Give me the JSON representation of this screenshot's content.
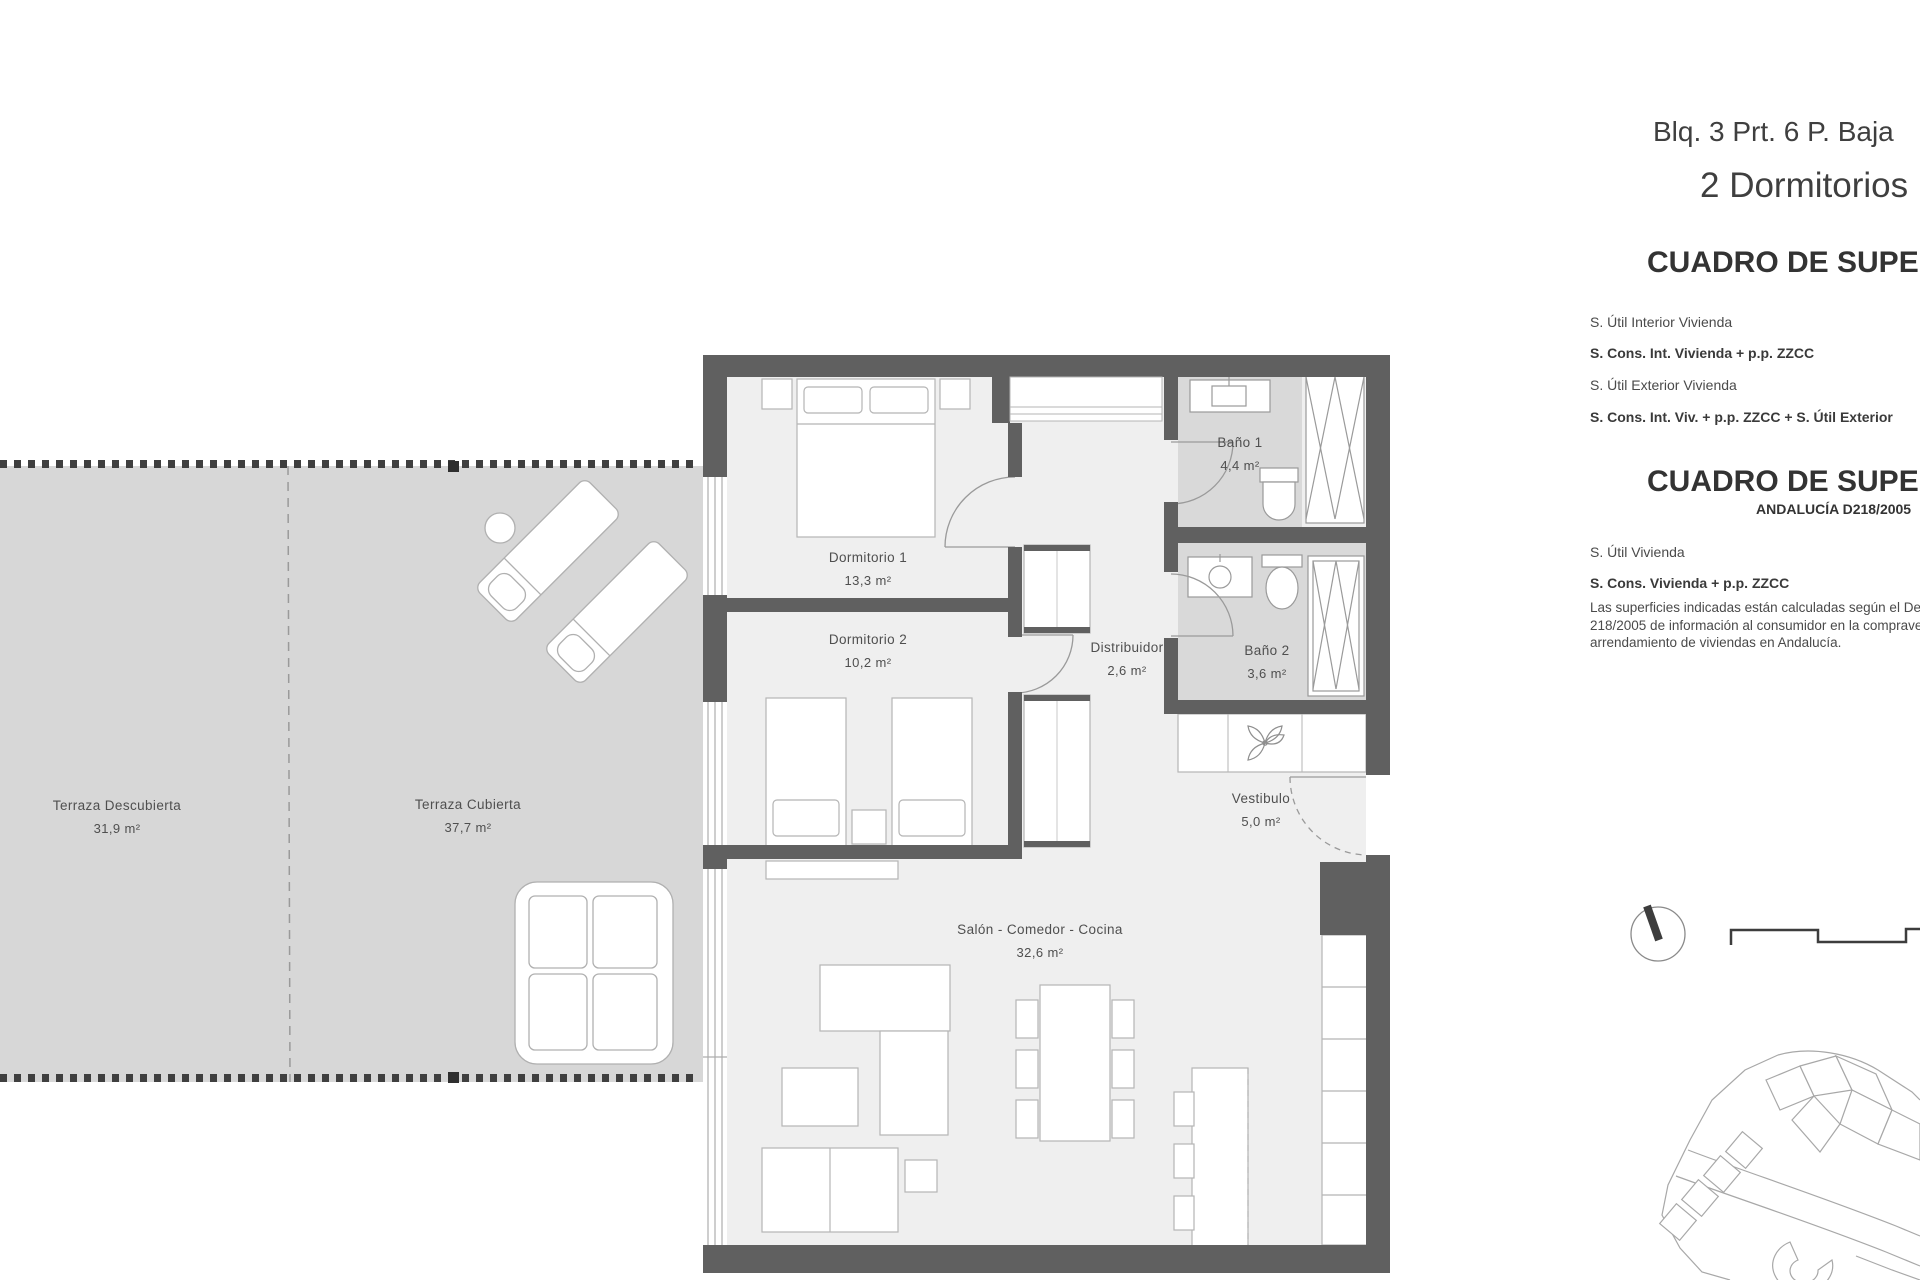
{
  "title": {
    "line1": "Blq. 3 Prt. 6 P. Baja",
    "line2": "2 Dormitorios"
  },
  "tables": {
    "t1": {
      "heading": "CUADRO DE SUPERFICIES",
      "rows": [
        "S. Útil Interior Vivienda",
        "S. Cons. Int. Vivienda + p.p. ZZCC",
        "S. Útil Exterior Vivienda",
        "S. Cons. Int. Viv. + p.p. ZZCC + S. Útil Exterior"
      ]
    },
    "t2": {
      "heading": "CUADRO DE SUPERFICIES",
      "subheading": "ANDALUCÍA D218/2005",
      "rows": [
        "S. Útil Vivienda",
        "S. Cons. Vivienda + p.p. ZZCC"
      ],
      "note": [
        "Las superficies indicadas están calculadas según el Decreto",
        "218/2005 de información al consumidor en la compraventa y",
        "arrendamiento de viviendas en Andalucía."
      ]
    }
  },
  "rooms": {
    "dormitorio1": {
      "label": "Dormitorio 1",
      "area": "13,3 m²"
    },
    "dormitorio2": {
      "label": "Dormitorio 2",
      "area": "10,2 m²"
    },
    "bano1": {
      "label": "Baño 1",
      "area": "4,4 m²"
    },
    "bano2": {
      "label": "Baño 2",
      "area": "3,6 m²"
    },
    "distribuidor": {
      "label": "Distribuidor",
      "area": "2,6 m²"
    },
    "vestibulo": {
      "label": "Vestibulo",
      "area": "5,0 m²"
    },
    "salon": {
      "label": "Salón - Comedor - Cocina",
      "area": "32,6 m²"
    },
    "terrazaDescubierta": {
      "label": "Terraza Descubierta",
      "area": "31,9 m²"
    },
    "terrazaCubierta": {
      "label": "Terraza Cubierta",
      "area": "37,7 m²"
    }
  },
  "colors": {
    "wall": "#606060",
    "floor": "#efefef",
    "bath_floor": "#d9d9d9",
    "terrace": "#d7d7d7",
    "furniture_line": "#b5b5b5",
    "text": "#4f4f4f"
  }
}
